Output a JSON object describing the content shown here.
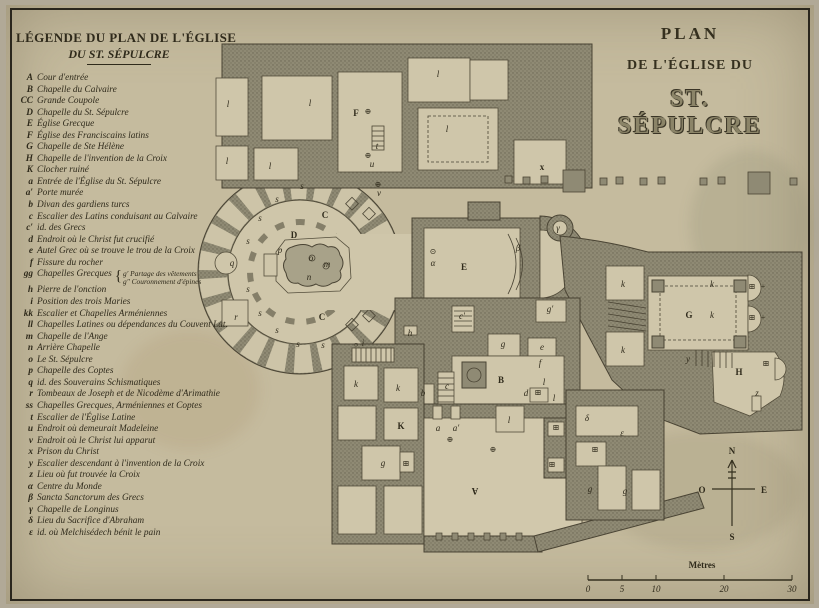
{
  "colors": {
    "paper": "#c5bb9e",
    "ink": "#35301f",
    "wall": "#8f8a74",
    "floor": "#cfc6aa"
  },
  "legend": {
    "title_line1": "LÉGENDE DU PLAN DE L'ÉGLISE",
    "title_line2": "DU ST. SÉPULCRE",
    "entries": [
      {
        "key": "A",
        "text": "Cour d'entrée"
      },
      {
        "key": "B",
        "text": "Chapelle du Calvaire"
      },
      {
        "key": "CC",
        "text": "Grande Coupole"
      },
      {
        "key": "D",
        "text": "Chapelle du St. Sépulcre"
      },
      {
        "key": "E",
        "text": "Église Grecque"
      },
      {
        "key": "F",
        "text": "Église des Franciscains latins"
      },
      {
        "key": "G",
        "text": "Chapelle de Ste Hélène"
      },
      {
        "key": "H",
        "text": "Chapelle de l'invention de la Croix"
      },
      {
        "key": "K",
        "text": "Clocher ruiné"
      },
      {
        "key": "a",
        "text": "Entrée de l'Église du St. Sépulcre"
      },
      {
        "key": "a′",
        "text": "Porte murée"
      },
      {
        "key": "b",
        "text": "Divan des gardiens turcs"
      },
      {
        "key": "c",
        "text": "Escalier des Latins conduisant au Calvaire"
      },
      {
        "key": "c′",
        "text": "id. des Grecs"
      },
      {
        "key": "d",
        "text": "Endroit où le Christ fut crucifié"
      },
      {
        "key": "e",
        "text": "Autel Grec où se trouve le trou de la Croix"
      },
      {
        "key": "f",
        "text": "Fissure du rocher"
      },
      {
        "key": "gg",
        "text": "Chapelles Grecques",
        "sub": [
          "g′ Partage des vêtements",
          "g″ Couronnement d'épines"
        ]
      },
      {
        "key": "h",
        "text": "Pierre de l'onction"
      },
      {
        "key": "i",
        "text": "Position des trois Maries"
      },
      {
        "key": "kk",
        "text": "Escalier et Chapelles Arméniennes"
      },
      {
        "key": "ll",
        "text": "Chapelles Latines ou dépendances du Couvent Lat."
      },
      {
        "key": "m",
        "text": "Chapelle de l'Ange"
      },
      {
        "key": "n",
        "text": "Arrière Chapelle"
      },
      {
        "key": "o",
        "text": "Le St. Sépulcre"
      },
      {
        "key": "p",
        "text": "Chapelle des Coptes"
      },
      {
        "key": "q",
        "text": "id. des Souverains Schismatiques"
      },
      {
        "key": "r",
        "text": "Tombeaux de Joseph et de Nicodème d'Arimathie"
      },
      {
        "key": "ss",
        "text": "Chapelles Grecques, Arméniennes et Coptes"
      },
      {
        "key": "t",
        "text": "Escalier de l'Église Latine"
      },
      {
        "key": "u",
        "text": "Endroit où demeurait Madeleine"
      },
      {
        "key": "v",
        "text": "Endroit où le Christ lui apparut"
      },
      {
        "key": "x",
        "text": "Prison du Christ"
      },
      {
        "key": "y",
        "text": "Escalier descendant à l'invention de la Croix"
      },
      {
        "key": "z",
        "text": "Lieu où fut trouvée la Croix"
      },
      {
        "key": "α",
        "text": "Centre du Monde"
      },
      {
        "key": "β",
        "text": "Sancta Sanctorum des Grecs"
      },
      {
        "key": "γ",
        "text": "Chapelle de Longinus"
      },
      {
        "key": "δ",
        "text": "Lieu du Sacrifice d'Abraham"
      },
      {
        "key": "ε",
        "text": "id. où Melchisédech bénit le pain"
      }
    ]
  },
  "title": {
    "line1": "PLAN",
    "line2": "DE L'ÉGLISE DU",
    "line3": "ST. SÉPULCRE"
  },
  "compass": {
    "n": "N",
    "s": "S",
    "e": "E",
    "o": "O"
  },
  "scale": {
    "label": "Mètres",
    "ticks": [
      "0",
      "5",
      "10",
      "20",
      "30"
    ]
  },
  "plan": {
    "labels": [
      {
        "t": "A",
        "x": 475,
        "y": 488,
        "s": 17,
        "c": "cap",
        "r": 180
      },
      {
        "t": "B",
        "x": 501,
        "y": 383,
        "s": 13,
        "c": "cap"
      },
      {
        "t": "C",
        "x": 325,
        "y": 218,
        "s": 12,
        "c": "cap"
      },
      {
        "t": "C",
        "x": 322,
        "y": 320,
        "s": 12,
        "c": "cap"
      },
      {
        "t": "D",
        "x": 294,
        "y": 238,
        "s": 11,
        "c": "cap"
      },
      {
        "t": "E",
        "x": 464,
        "y": 270,
        "s": 15,
        "c": "cap"
      },
      {
        "t": "F",
        "x": 356,
        "y": 116,
        "s": 12,
        "c": "cap"
      },
      {
        "t": "G",
        "x": 689,
        "y": 318,
        "s": 12,
        "c": "cap"
      },
      {
        "t": "H",
        "x": 739,
        "y": 375,
        "s": 12,
        "c": "cap"
      },
      {
        "t": "K",
        "x": 401,
        "y": 429,
        "s": 11,
        "c": "cap"
      },
      {
        "t": "x",
        "x": 542,
        "y": 170,
        "s": 10,
        "c": "cap"
      },
      {
        "t": "l",
        "x": 228,
        "y": 107
      },
      {
        "t": "l",
        "x": 310,
        "y": 106
      },
      {
        "t": "l",
        "x": 438,
        "y": 77
      },
      {
        "t": "l",
        "x": 447,
        "y": 132
      },
      {
        "t": "l",
        "x": 227,
        "y": 164
      },
      {
        "t": "l",
        "x": 270,
        "y": 169
      },
      {
        "t": "l",
        "x": 544,
        "y": 385
      },
      {
        "t": "l",
        "x": 554,
        "y": 401
      },
      {
        "t": "l",
        "x": 509,
        "y": 423
      },
      {
        "t": "s",
        "x": 302,
        "y": 189
      },
      {
        "t": "s",
        "x": 277,
        "y": 202
      },
      {
        "t": "s",
        "x": 260,
        "y": 221
      },
      {
        "t": "s",
        "x": 248,
        "y": 244
      },
      {
        "t": "s",
        "x": 248,
        "y": 292
      },
      {
        "t": "s",
        "x": 260,
        "y": 316
      },
      {
        "t": "s",
        "x": 277,
        "y": 333
      },
      {
        "t": "s",
        "x": 298,
        "y": 347
      },
      {
        "t": "s",
        "x": 323,
        "y": 348
      },
      {
        "t": "q",
        "x": 232,
        "y": 266
      },
      {
        "t": "r",
        "x": 236,
        "y": 320
      },
      {
        "t": "p",
        "x": 280,
        "y": 253
      },
      {
        "t": "o",
        "x": 311,
        "y": 261
      },
      {
        "t": "m",
        "x": 327,
        "y": 267
      },
      {
        "t": "n",
        "x": 309,
        "y": 280
      },
      {
        "t": "t",
        "x": 377,
        "y": 149
      },
      {
        "t": "u",
        "x": 372,
        "y": 167
      },
      {
        "t": "v",
        "x": 379,
        "y": 196
      },
      {
        "t": "h",
        "x": 410,
        "y": 336
      },
      {
        "t": "i",
        "x": 363,
        "y": 346
      },
      {
        "t": "c",
        "x": 447,
        "y": 389
      },
      {
        "t": "c′",
        "x": 462,
        "y": 319
      },
      {
        "t": "b",
        "x": 423,
        "y": 396
      },
      {
        "t": "d",
        "x": 526,
        "y": 396
      },
      {
        "t": "e",
        "x": 542,
        "y": 350
      },
      {
        "t": "f",
        "x": 540,
        "y": 366
      },
      {
        "t": "g",
        "x": 503,
        "y": 347
      },
      {
        "t": "g′",
        "x": 550,
        "y": 312
      },
      {
        "t": "g",
        "x": 383,
        "y": 466
      },
      {
        "t": "g",
        "x": 590,
        "y": 492
      },
      {
        "t": "g",
        "x": 625,
        "y": 494
      },
      {
        "t": "a",
        "x": 438,
        "y": 431
      },
      {
        "t": "a′",
        "x": 456,
        "y": 431
      },
      {
        "t": "k",
        "x": 623,
        "y": 287
      },
      {
        "t": "k",
        "x": 623,
        "y": 353
      },
      {
        "t": "k",
        "x": 356,
        "y": 387
      },
      {
        "t": "k",
        "x": 398,
        "y": 391
      },
      {
        "t": "k",
        "x": 712,
        "y": 287
      },
      {
        "t": "k",
        "x": 712,
        "y": 318
      },
      {
        "t": "y",
        "x": 688,
        "y": 362
      },
      {
        "t": "z",
        "x": 757,
        "y": 396
      },
      {
        "t": "α",
        "x": 433,
        "y": 266
      },
      {
        "t": "β",
        "x": 518,
        "y": 251
      },
      {
        "t": "γ",
        "x": 558,
        "y": 231
      },
      {
        "t": "δ",
        "x": 587,
        "y": 421
      },
      {
        "t": "ε",
        "x": 622,
        "y": 436
      },
      {
        "t": "⊕",
        "x": 368,
        "y": 158,
        "c": "sym"
      },
      {
        "t": "⊕",
        "x": 378,
        "y": 187,
        "c": "sym"
      },
      {
        "t": "⊕",
        "x": 368,
        "y": 114,
        "c": "sym"
      },
      {
        "t": "⊕",
        "x": 450,
        "y": 442,
        "c": "sym"
      },
      {
        "t": "⊕",
        "x": 493,
        "y": 452,
        "c": "sym"
      },
      {
        "t": "⊙",
        "x": 433,
        "y": 254,
        "c": "sym"
      },
      {
        "t": "○",
        "x": 356,
        "y": 347,
        "s": 7,
        "c": "sym"
      },
      {
        "t": "⊞",
        "x": 538,
        "y": 395,
        "c": "sym"
      },
      {
        "t": "⊞",
        "x": 556,
        "y": 430,
        "c": "sym"
      },
      {
        "t": "⊞",
        "x": 552,
        "y": 467,
        "c": "sym"
      },
      {
        "t": "⊞",
        "x": 406,
        "y": 466,
        "c": "sym"
      },
      {
        "t": "⊞",
        "x": 752,
        "y": 289,
        "c": "sym"
      },
      {
        "t": "⊞",
        "x": 752,
        "y": 320,
        "c": "sym"
      },
      {
        "t": "+",
        "x": 763,
        "y": 289,
        "c": "sym"
      },
      {
        "t": "+",
        "x": 763,
        "y": 320,
        "c": "sym"
      },
      {
        "t": "⊞",
        "x": 766,
        "y": 366,
        "c": "sym"
      },
      {
        "t": "⊞",
        "x": 595,
        "y": 452,
        "c": "sym"
      }
    ]
  }
}
